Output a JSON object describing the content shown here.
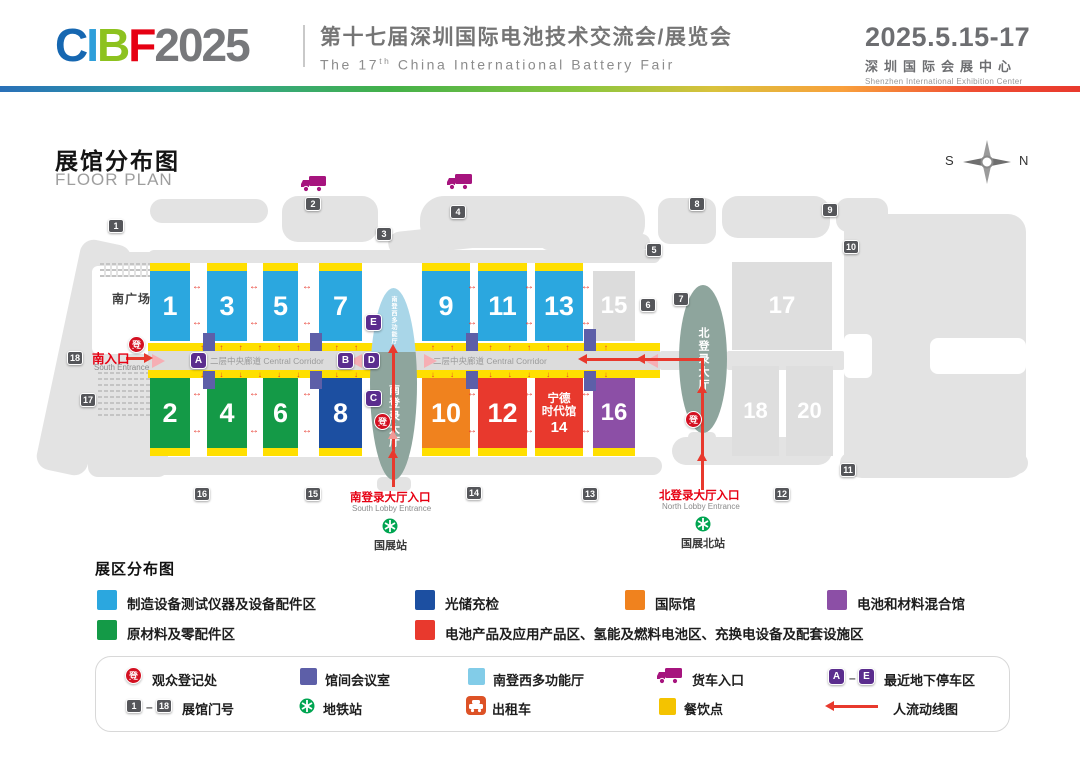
{
  "palette": {
    "hall_blue": "#2BA7DF",
    "hall_green": "#149A47",
    "hall_navy": "#1C4FA1",
    "hall_orange": "#F0821E",
    "hall_red": "#E8392D",
    "hall_purple": "#8C4FA6",
    "hall_gray": "#DCDCDC",
    "strip_yellow": "#FFDF00",
    "meeting_slate": "#5D5FA8",
    "marker_purple": "#5B2D8E",
    "gate_gray": "#55565A",
    "lobby_green": "#8EA59D",
    "lobby_blue": "#A9D6E8",
    "metro_green": "#00A551",
    "truck_magenta": "#A6147E",
    "taxi_orange": "#DD5226",
    "flow_red": "#E8392D",
    "entrance_red": "#E60012",
    "legend_yellow": "#F4C300",
    "legend_lightblue": "#82CCE8"
  },
  "header": {
    "logo": {
      "c": "C",
      "i": "I",
      "b": "B",
      "f": "F",
      "year": "2025"
    },
    "title_cn": "第十七届深圳国际电池技术交流会/展览会",
    "title_en_pre": "The 17",
    "title_en_sup": "th",
    "title_en_post": " China International Battery Fair",
    "date": "2025.5.15-17",
    "venue_cn": "深圳国际会展中心",
    "venue_en": "Shenzhen International Exhibition Center"
  },
  "map": {
    "title_cn": "展馆分布图",
    "title_en": "FLOOR PLAN",
    "compass_s": "S",
    "compass_n": "N",
    "south_plaza": "南广场",
    "corridor_label": "二层中央廊道 Central Corridor",
    "south_lobby": "南登录大厅",
    "south_lobby_west": "南登西多功能厅",
    "north_lobby": "北登录大厅",
    "halls": {
      "h1": "1",
      "h2": "2",
      "h3": "3",
      "h4": "4",
      "h5": "5",
      "h6": "6",
      "h7": "7",
      "h8": "8",
      "h9": "9",
      "h10": "10",
      "h11": "11",
      "h12": "12",
      "h13": "13",
      "h15": "15",
      "h16": "16",
      "h17": "17",
      "h18": "18",
      "h20": "20"
    },
    "hall14_l1": "宁德",
    "hall14_l2": "时代馆",
    "hall14_l3": "14",
    "gates": [
      "1",
      "2",
      "3",
      "4",
      "5",
      "6",
      "7",
      "8",
      "9",
      "10",
      "11",
      "12",
      "13",
      "14",
      "15",
      "16",
      "17",
      "18"
    ],
    "markers": {
      "a": "A",
      "b": "B",
      "c": "C",
      "d": "D",
      "e": "E"
    },
    "reg": "登",
    "south_entrance_cn": "南入口",
    "south_entrance_en": "South Entrance",
    "south_lobby_entrance_cn": "南登录大厅入口",
    "south_lobby_entrance_en": "South Lobby Entrance",
    "north_lobby_entrance_cn": "北登录大厅入口",
    "north_lobby_entrance_en": "North Lobby Entrance",
    "metro_south": "国展站",
    "metro_north": "国展北站",
    "arrow_up_row": "↑ ↑ ↑ ↑ ↑ ↑ ↑ ↑ ↑ ↑ ↑ ↑ ↑ ↑ ↑ ↑ ↑ ↑ ↑ ↑ ↑ ↑",
    "arrow_down_row": "↓ ↓ ↓ ↓ ↓ ↓ ↓ ↓ ↓ ↓ ↓ ↓ ↓ ↓ ↓ ↓ ↓ ↓ ↓ ↓ ↓ ↓",
    "arrow_h": "↔"
  },
  "zones": {
    "title": "展区分布图",
    "items": [
      {
        "label": "制造设备测试仪器及设备配件区",
        "color": "#2BA7DF"
      },
      {
        "label": "光储充检",
        "color": "#1C4FA1"
      },
      {
        "label": "国际馆",
        "color": "#F0821E"
      },
      {
        "label": "电池和材料混合馆",
        "color": "#8C4FA6"
      },
      {
        "label": "原材料及零配件区",
        "color": "#149A47"
      },
      {
        "label": "电池产品及应用产品区、氢能及燃料电池区、充换电设备及配套设施区",
        "color": "#E8392D"
      }
    ]
  },
  "symbols": {
    "reg_label": "观众登记处",
    "meeting_label": "馆间会议室",
    "multihall_label": "南登西多功能厅",
    "truck_label": "货车入口",
    "parking_label": "最近地下停车区",
    "parking_from": "A",
    "parking_to": "E",
    "gateno_label": "展馆门号",
    "gate_from": "1",
    "gate_to": "18",
    "metro_label": "地铁站",
    "taxi_label": "出租车",
    "dining_label": "餐饮点",
    "flow_label": "人流动线图",
    "dash": "–"
  }
}
